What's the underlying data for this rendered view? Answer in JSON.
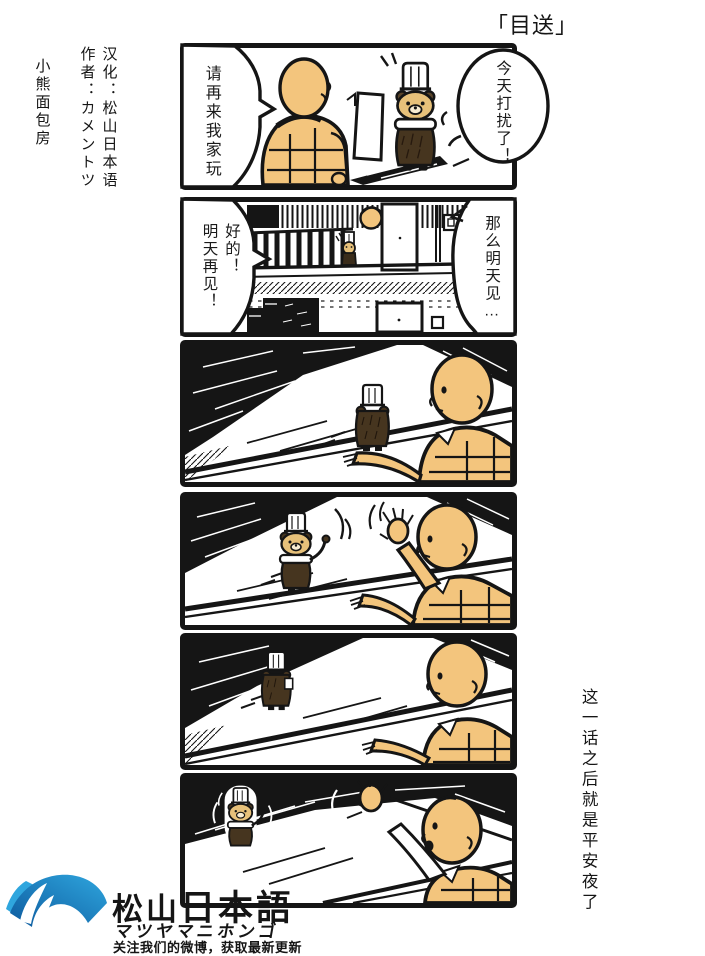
{
  "page": {
    "title": "「目送」",
    "credits": {
      "translation": "汉化：松山日本语",
      "author": "作者：カメントツ",
      "group": "小熊面包房"
    },
    "side_note": "这一话之后就是平安夜了"
  },
  "dialogue": {
    "p1_left": "请再来我家玩",
    "p1_right": "今天打扰了！",
    "p2_left_col1": "好的！",
    "p2_left_col2": "明天再见！",
    "p2_right": "那么明天见…"
  },
  "footer": {
    "logo_icon": "blue-fan-logo",
    "brand_cn": "松山",
    "brand_jp": "日本語",
    "brand_kana": "マツヤマニホンゴ",
    "tagline": "关注我们的微博，获取最新更新"
  },
  "colors": {
    "ink": "#151515",
    "skin": "#f3c57d",
    "bear_face": "#e7c17a",
    "bear_body": "#46351f",
    "logo_blue_dark": "#0d5a9e",
    "logo_blue_light": "#2fa6de"
  }
}
